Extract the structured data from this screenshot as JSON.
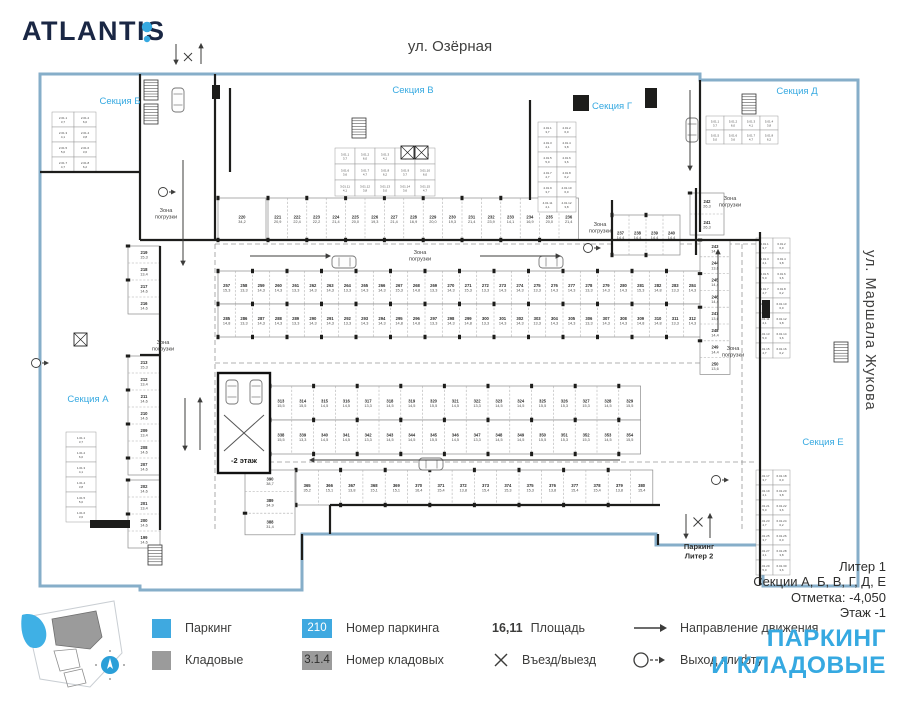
{
  "brand": {
    "name": "ATLANTIS"
  },
  "colors": {
    "accent": "#36a9e1",
    "swatch_blue": "#3fa9e0",
    "swatch_gray": "#9b9b9b",
    "perimeter": "#86aec9",
    "wall": "#1d1d1b",
    "text": "#3c3c3b"
  },
  "streets": {
    "top": "ул. Озёрная",
    "right": "ул. Маршала Жукова"
  },
  "info": {
    "liter": "Литер 1",
    "sections": "Секции А, Б, В, Г, Д, Е",
    "mark": "Отметка:  -4,050",
    "floor": "Этаж  -1"
  },
  "title": {
    "line1": "ПАРКИНГ",
    "line2": "И КЛАДОВЫЕ"
  },
  "legend": {
    "parking_label": "Паркинг",
    "storage_label": "Кладовые",
    "parking_num_sample": "210",
    "parking_num_label": "Номер паркинга",
    "storage_num_sample": "3.1.4",
    "storage_num_label": "Номер кладовых",
    "area_sample": "16,11",
    "area_label": "Площадь",
    "entry_label": "Въезд/выезд",
    "direction_label": "Направление движения",
    "lift_exit_label": "Выход клифту"
  },
  "plan": {
    "outline": "M40,74 L700,74 L700,80 L858,80 L858,586 L763,586 L763,545 L656,545 L656,534 L302,534 L302,590 L140,590 L140,586 L40,586 Z",
    "sections": [
      {
        "label": "Секция Б",
        "x": 120,
        "y": 104
      },
      {
        "label": "Секция В",
        "x": 413,
        "y": 93
      },
      {
        "label": "Секция Г",
        "x": 612,
        "y": 109
      },
      {
        "label": "Секция Д",
        "x": 797,
        "y": 94
      },
      {
        "label": "Секция А",
        "x": 88,
        "y": 402
      },
      {
        "label": "Секция Е",
        "x": 823,
        "y": 445
      }
    ],
    "zones": [
      {
        "x": 166,
        "y": 212
      },
      {
        "x": 163,
        "y": 344
      },
      {
        "x": 420,
        "y": 254
      },
      {
        "x": 600,
        "y": 226
      },
      {
        "x": 730,
        "y": 200
      },
      {
        "x": 733,
        "y": 350
      }
    ],
    "zone_text": [
      "Зона",
      "погрузки"
    ],
    "ramp": {
      "rect": [
        218,
        373,
        52,
        100
      ],
      "label": "-2 этаж"
    },
    "exit_bottom": {
      "line1": "Паркинг",
      "line2": "Литер 2",
      "x": 699,
      "y": 549
    },
    "rows": [
      {
        "x": 218,
        "y": 271,
        "cw": 17.25,
        "ch": 33,
        "count": 28,
        "start": 257,
        "dir": "h",
        "areas": [
          "15,3",
          "13,3",
          "14,3",
          "14,3",
          "13,3",
          "14,3",
          "14,3",
          "13,3",
          "14,3",
          "14,3",
          "15,3",
          "14,8",
          "13,3",
          "14,3"
        ]
      },
      {
        "x": 218,
        "y": 304,
        "cw": 17.25,
        "ch": 33,
        "count": 28,
        "start": 285,
        "dir": "h",
        "areas": [
          "14,8",
          "13,3",
          "14,3",
          "14,3",
          "13,3",
          "14,3",
          "14,3",
          "13,3",
          "14,3",
          "14,3",
          "14,8",
          "14,8",
          "13,3",
          "14,3"
        ]
      },
      {
        "x": 270,
        "y": 386,
        "cw": 21.8,
        "ch": 34,
        "count": 17,
        "start": 313,
        "dir": "h",
        "areas": [
          "15,5",
          "15,5",
          "14,5",
          "14,5",
          "13,3",
          "14,5",
          "14,5",
          "15,5",
          "14,5",
          "13,3",
          "14,5",
          "14,5",
          "15,5",
          "15,3",
          "15,3",
          "14,5",
          "15,5"
        ]
      },
      {
        "x": 270,
        "y": 420,
        "cw": 21.8,
        "ch": 34,
        "count": 17,
        "start": 338,
        "dir": "h",
        "areas": [
          "15,5",
          "13,3",
          "14,5",
          "14,5",
          "13,3",
          "14,5",
          "14,5",
          "15,5",
          "14,5",
          "13,3",
          "14,5",
          "14,5",
          "15,5",
          "15,3",
          "15,3",
          "14,5",
          "15,5"
        ]
      },
      {
        "x": 296,
        "y": 470,
        "cw": 22.3,
        "ch": 35,
        "count": 16,
        "start": 365,
        "dir": "h",
        "areas": [
          "35,2",
          "15,1",
          "13,8",
          "15,1",
          "15,1",
          "16,4",
          "15,4",
          "13,8",
          "15,4",
          "15,3",
          "15,3",
          "13,8",
          "15,4",
          "15,4",
          "13,8",
          "15,4"
        ]
      },
      {
        "x": 218,
        "y": 198,
        "cw": 48,
        "ch": 42,
        "count": 1,
        "start": 220,
        "dir": "h",
        "areas": [
          "34,2"
        ]
      },
      {
        "x": 268,
        "y": 198,
        "cw": 19.4,
        "ch": 42,
        "count": 16,
        "start": 221,
        "dir": "h",
        "areas": [
          "20,9",
          "22,4",
          "22,2",
          "21,4",
          "20,0",
          "19,3",
          "21,4",
          "16,9",
          "20,0",
          "19,3",
          "21,4",
          "23,9",
          "14,1",
          "16,9",
          "20,0",
          "21,4"
        ]
      },
      {
        "x": 612,
        "y": 215,
        "cw": 17,
        "ch": 40,
        "count": 4,
        "start": 237,
        "dir": "h",
        "areas": [
          "14,4",
          "14,4",
          "14,4",
          "14,4"
        ]
      },
      {
        "x": 128,
        "y": 246,
        "cw": 32,
        "ch": 17,
        "count": 4,
        "start": 219,
        "step": -1,
        "dir": "v",
        "areas": [
          "15,3",
          "13,4",
          "14,6",
          "14,6"
        ]
      },
      {
        "x": 128,
        "y": 356,
        "cw": 32,
        "ch": 17,
        "count": 7,
        "start": 213,
        "step": -1,
        "dir": "v",
        "areas": [
          "15,3",
          "13,4",
          "14,6",
          "14,6",
          "13,4",
          "14,6",
          "14,6"
        ]
      },
      {
        "x": 128,
        "y": 480,
        "cw": 32,
        "ch": 17,
        "count": 4,
        "start": 202,
        "step": -1,
        "dir": "v",
        "areas": [
          "14,6",
          "13,4",
          "14,6",
          "14,6"
        ]
      },
      {
        "x": 700,
        "y": 240,
        "cw": 30,
        "ch": 16.8,
        "count": 8,
        "start": 243,
        "dir": "v",
        "areas": [
          "14,4",
          "13,6",
          "14,4",
          "14,4",
          "13,6",
          "14,4",
          "14,4",
          "13,6"
        ]
      },
      {
        "x": 245,
        "y": 470,
        "cw": 50,
        "ch": 21.6,
        "count": 3,
        "start": 390,
        "step": -1,
        "dir": "v",
        "areas": [
          "38,7",
          "34,9",
          "31,4"
        ]
      },
      {
        "x": 690,
        "y": 193,
        "cw": 34,
        "ch": 21,
        "count": 2,
        "start": 242,
        "step": -1,
        "dir": "v",
        "areas": [
          "26,3",
          "26,3"
        ]
      }
    ],
    "storages": [
      {
        "x": 335,
        "y": 148,
        "cols": 5,
        "rows": 3,
        "cw": 20,
        "ch": 16,
        "prefix": "3.01.",
        "start": 1
      },
      {
        "x": 538,
        "y": 122,
        "cols": 2,
        "rows": 6,
        "cw": 19,
        "ch": 15,
        "prefix": "4.01.",
        "start": 1
      },
      {
        "x": 706,
        "y": 116,
        "cols": 4,
        "rows": 2,
        "cw": 18,
        "ch": 14,
        "prefix": "5.01.",
        "start": 1
      },
      {
        "x": 756,
        "y": 238,
        "cols": 2,
        "rows": 8,
        "cw": 17,
        "ch": 15,
        "prefix": "6.01.",
        "start": 1
      },
      {
        "x": 756,
        "y": 470,
        "cols": 2,
        "rows": 7,
        "cw": 17,
        "ch": 15,
        "prefix": "6.01.",
        "start": 17
      },
      {
        "x": 52,
        "y": 112,
        "cols": 2,
        "rows": 4,
        "cw": 22,
        "ch": 15,
        "prefix": "2.01.",
        "start": 1
      },
      {
        "x": 66,
        "y": 432,
        "cols": 1,
        "rows": 6,
        "cw": 30,
        "ch": 15,
        "prefix": "1.01.",
        "start": 1
      }
    ],
    "storage_areas": [
      "6,2",
      "3,7",
      "6,0",
      "4,1",
      "3,8",
      "5,0",
      "3,6",
      "4,7"
    ],
    "walls": [
      [
        215,
        74,
        215,
        240
      ],
      [
        140,
        74,
        140,
        240
      ],
      [
        140,
        240,
        760,
        240
      ],
      [
        230,
        88,
        230,
        172
      ],
      [
        40,
        172,
        140,
        172
      ],
      [
        160,
        246,
        160,
        530
      ],
      [
        530,
        100,
        530,
        200
      ],
      [
        700,
        80,
        700,
        232
      ],
      [
        760,
        232,
        760,
        585
      ],
      [
        330,
        505,
        660,
        505
      ],
      [
        330,
        505,
        330,
        534
      ],
      [
        658,
        534,
        658,
        545
      ],
      [
        302,
        534,
        302,
        560
      ],
      [
        140,
        355,
        160,
        355
      ],
      [
        612,
        200,
        612,
        255
      ],
      [
        696,
        188,
        696,
        255
      ]
    ],
    "wall_blocks": [
      [
        573,
        95,
        16,
        16
      ],
      [
        212,
        85,
        8,
        14
      ],
      [
        762,
        300,
        8,
        18
      ],
      [
        90,
        520,
        40,
        8
      ],
      [
        645,
        88,
        12,
        20
      ]
    ],
    "lanes": [
      [
        215,
        244,
        757,
        244
      ],
      [
        215,
        363,
        700,
        363
      ],
      [
        245,
        462,
        757,
        462
      ],
      [
        215,
        244,
        215,
        530
      ],
      [
        742,
        244,
        742,
        530
      ]
    ],
    "arrows": [
      [
        176,
        44,
        176,
        64
      ],
      [
        201,
        64,
        201,
        44
      ],
      [
        188,
        61
      ],
      [
        250,
        256,
        330,
        256
      ],
      [
        480,
        256,
        560,
        256
      ],
      [
        620,
        460,
        310,
        460
      ],
      [
        183,
        160,
        183,
        265
      ],
      [
        185,
        398,
        185,
        450
      ],
      [
        200,
        450,
        200,
        398
      ],
      [
        690,
        90,
        690,
        170
      ],
      [
        718,
        330,
        718,
        250
      ],
      [
        686,
        514,
        686,
        538
      ],
      [
        710,
        538,
        710,
        514
      ]
    ],
    "crosses": [
      [
        188,
        57,
        8
      ],
      [
        698,
        522,
        9
      ]
    ],
    "lift_exits": [
      [
        163,
        192
      ],
      [
        588,
        248
      ],
      [
        36,
        363
      ],
      [
        716,
        480
      ]
    ],
    "cars": [
      {
        "x": 172,
        "y": 88,
        "rot": 0
      },
      {
        "x": 226,
        "y": 380,
        "rot": 0
      },
      {
        "x": 250,
        "y": 380,
        "rot": 0
      },
      {
        "x": 338,
        "y": 250,
        "rot": 90
      },
      {
        "x": 545,
        "y": 250,
        "rot": 90
      },
      {
        "x": 425,
        "y": 452,
        "rot": 90
      },
      {
        "x": 686,
        "y": 118,
        "rot": 0
      }
    ],
    "stairs": [
      {
        "x": 144,
        "y": 80
      },
      {
        "x": 144,
        "y": 104
      },
      {
        "x": 352,
        "y": 118
      },
      {
        "x": 742,
        "y": 94
      },
      {
        "x": 148,
        "y": 545
      },
      {
        "x": 834,
        "y": 342
      }
    ],
    "xboxes": [
      [
        401,
        146
      ],
      [
        415,
        146
      ],
      [
        74,
        333
      ]
    ]
  }
}
